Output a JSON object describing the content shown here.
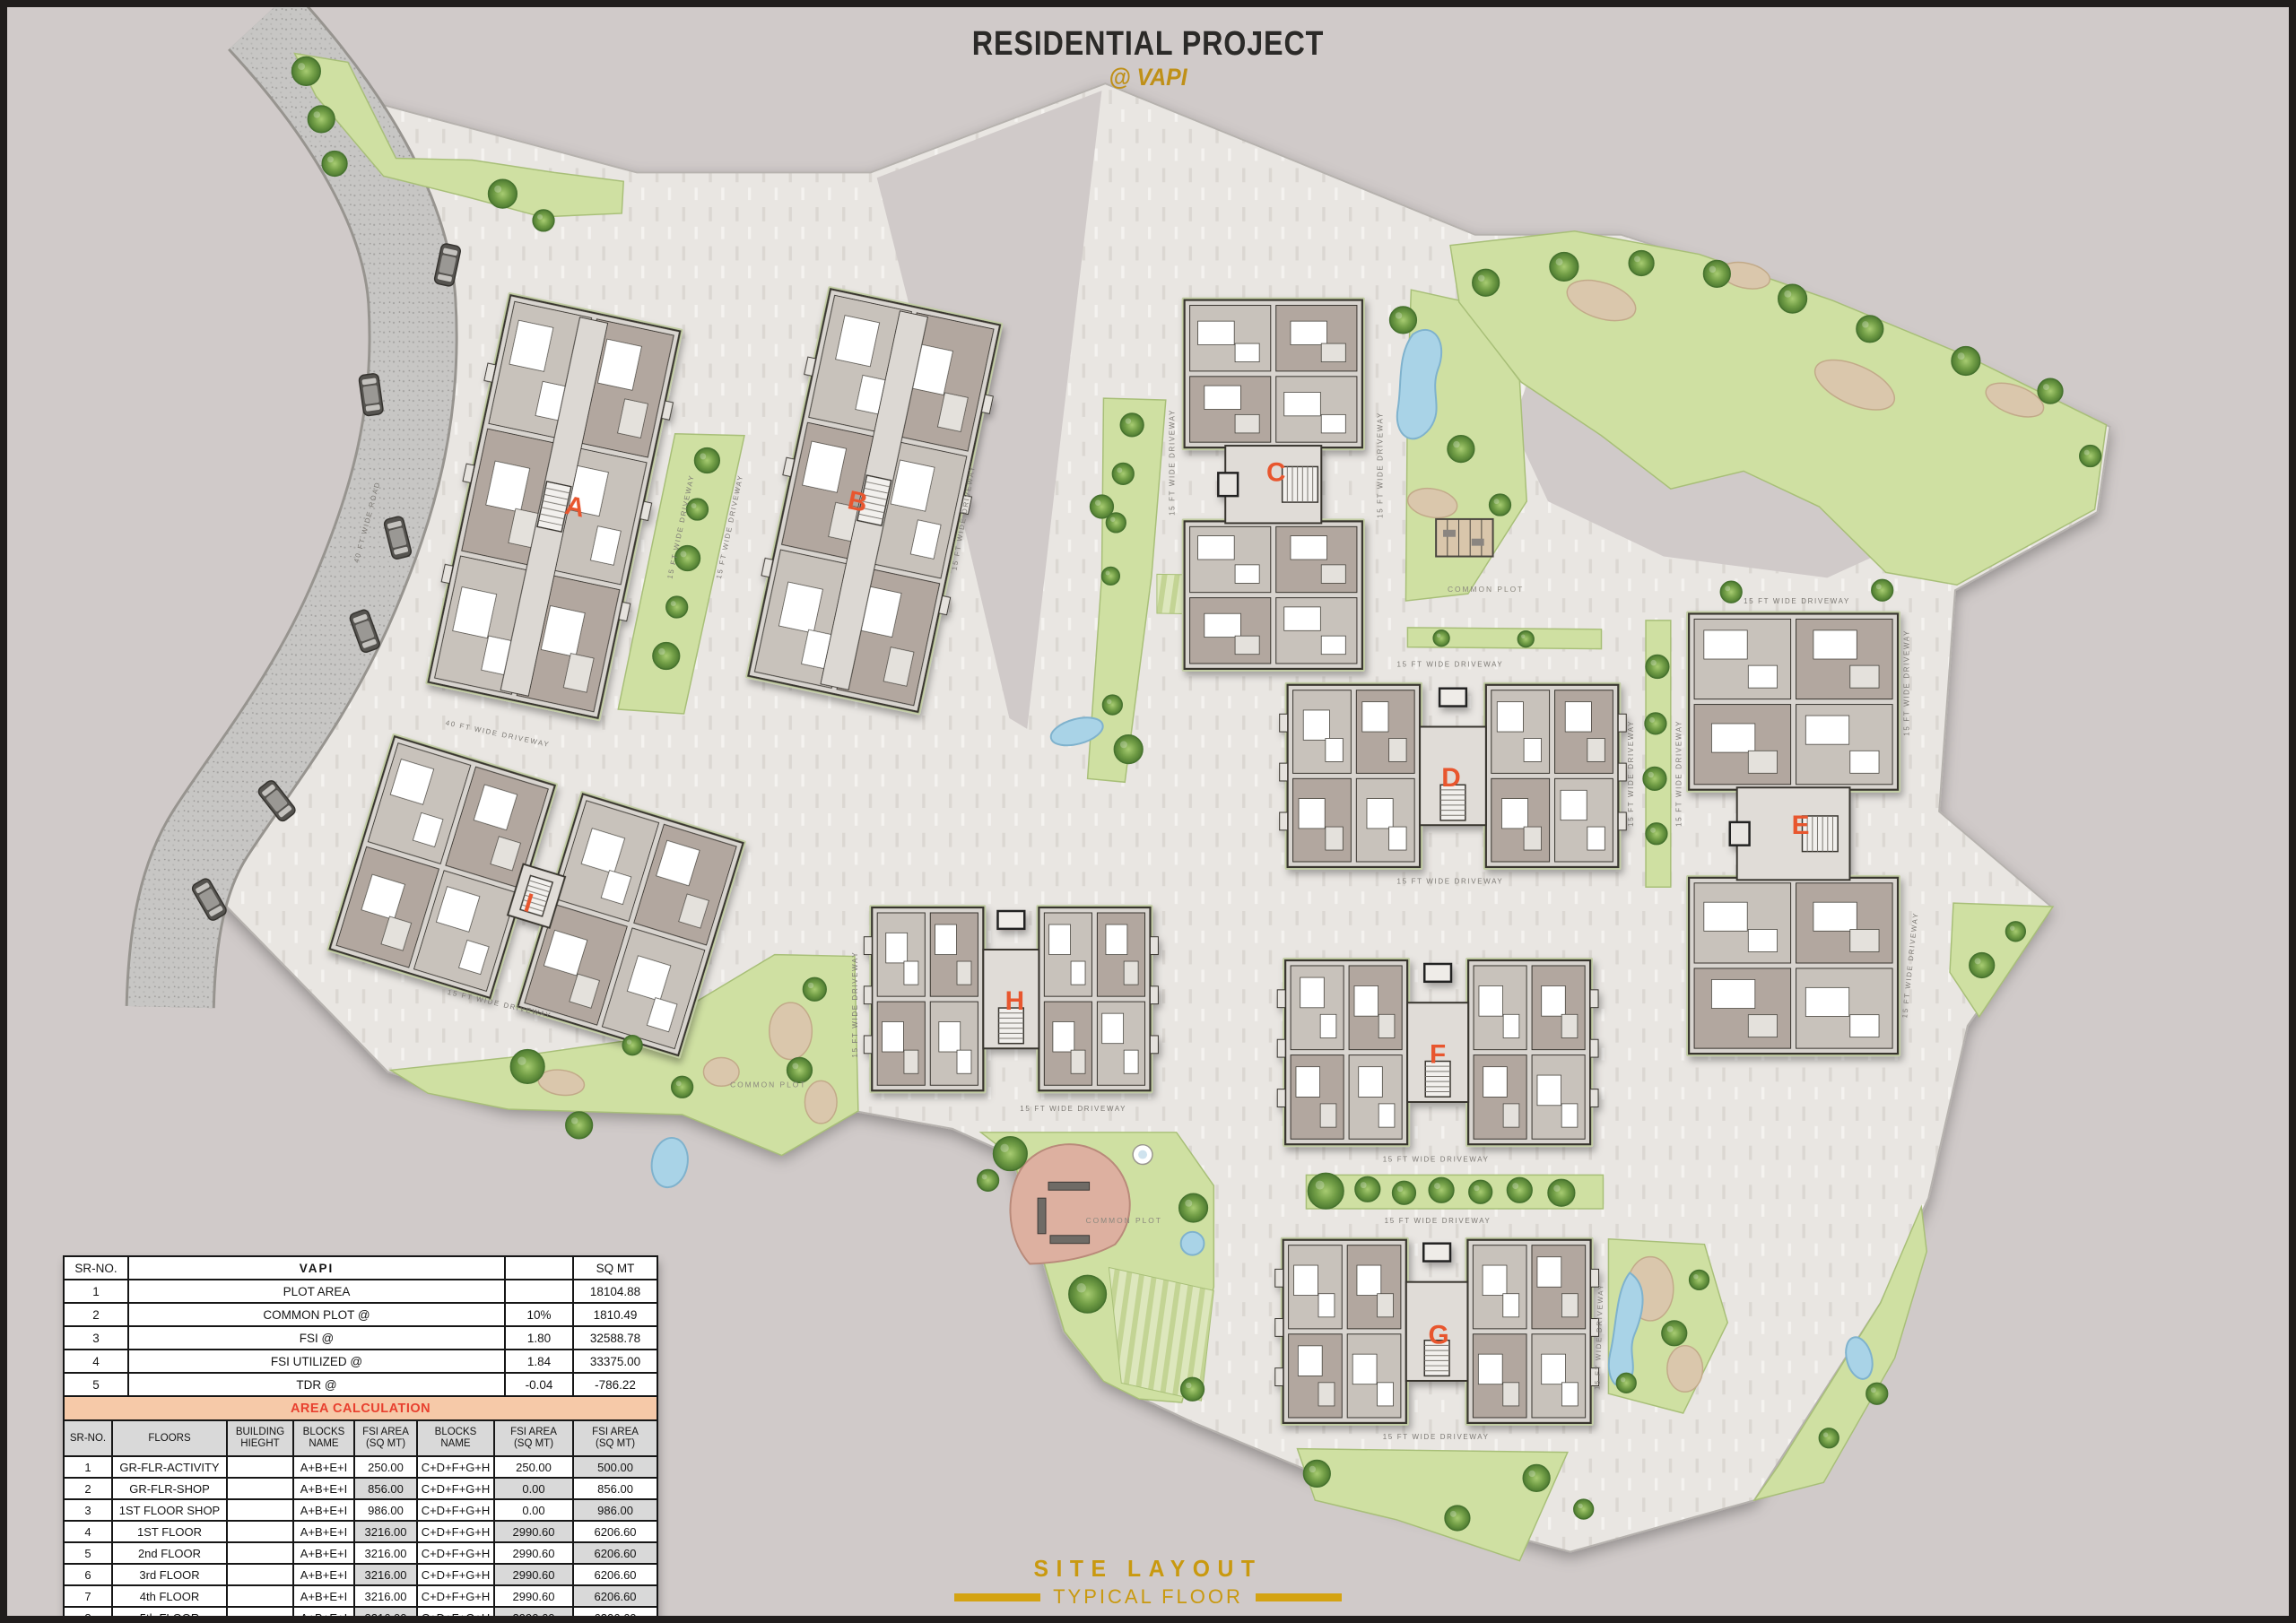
{
  "title": {
    "main": "RESIDENTIAL PROJECT",
    "sub": "@ VAPI"
  },
  "footer": {
    "line1": "SITE LAYOUT",
    "line2": "TYPICAL FLOOR"
  },
  "plan": {
    "road_label": "40 FT WIDE ROAD",
    "driveway40_label": "40 FT WIDE DRIVEWAY",
    "driveway15_label": "15 FT WIDE DRIVEWAY",
    "common_plot_label": "COMMON PLOT",
    "buildings": [
      {
        "letter": "A"
      },
      {
        "letter": "B"
      },
      {
        "letter": "C"
      },
      {
        "letter": "D"
      },
      {
        "letter": "E"
      },
      {
        "letter": "F"
      },
      {
        "letter": "G"
      },
      {
        "letter": "H"
      },
      {
        "letter": "I"
      }
    ]
  },
  "summary_table": {
    "header": {
      "sr": "SR-NO.",
      "city": "VAPI",
      "blank": "",
      "unit": "SQ MT"
    },
    "rows": [
      {
        "sr": "1",
        "label": "PLOT AREA",
        "ratio": "",
        "value": "18104.88",
        "ratio_class": "",
        "value_class": ""
      },
      {
        "sr": "2",
        "label": "COMMON PLOT @",
        "ratio": "10%",
        "value": "1810.49",
        "ratio_class": "red",
        "value_class": ""
      },
      {
        "sr": "3",
        "label": "FSI @",
        "ratio": "1.80",
        "value": "32588.78",
        "ratio_class": "red",
        "value_class": ""
      },
      {
        "sr": "4",
        "label": "FSI UTILIZED @",
        "ratio": "1.84",
        "value": "33375.00",
        "ratio_class": "red",
        "value_class": ""
      },
      {
        "sr": "5",
        "label": "TDR @",
        "ratio": "-0.04",
        "value": "-786.22",
        "ratio_class": "green",
        "value_class": "red"
      }
    ]
  },
  "area_table": {
    "section_title": "AREA CALCULATION",
    "columns": [
      {
        "l1": "SR-NO.",
        "l2": ""
      },
      {
        "l1": "FLOORS",
        "l2": ""
      },
      {
        "l1": "BUILDING",
        "l2": "HIEGHT"
      },
      {
        "l1": "BLOCKS",
        "l2": "NAME"
      },
      {
        "l1": "FSI AREA",
        "l2": "(SQ MT)"
      },
      {
        "l1": "BLOCKS",
        "l2": "NAME"
      },
      {
        "l1": "FSI AREA",
        "l2": "(SQ MT)"
      },
      {
        "l1": "FSI AREA",
        "l2": "(SQ MT)"
      }
    ],
    "rows": [
      {
        "sr": "1",
        "floor": "GR-FLR-ACTIVITY",
        "height": "",
        "b1": "A+B+E+I",
        "a1": "250.00",
        "b2": "C+D+F+G+H",
        "a2": "250.00",
        "total": "500.00",
        "hl": [
          "total"
        ]
      },
      {
        "sr": "2",
        "floor": "GR-FLR-SHOP",
        "height": "",
        "b1": "A+B+E+I",
        "a1": "856.00",
        "b2": "C+D+F+G+H",
        "a2": "0.00",
        "total": "856.00",
        "hl": [
          "a1",
          "a2"
        ]
      },
      {
        "sr": "3",
        "floor": "1ST FLOOR SHOP",
        "height": "",
        "b1": "A+B+E+I",
        "a1": "986.00",
        "b2": "C+D+F+G+H",
        "a2": "0.00",
        "total": "986.00",
        "hl": [
          "total"
        ]
      },
      {
        "sr": "4",
        "floor": "1ST FLOOR",
        "height": "",
        "b1": "A+B+E+I",
        "a1": "3216.00",
        "b2": "C+D+F+G+H",
        "a2": "2990.60",
        "total": "6206.60",
        "hl": [
          "a1",
          "a2"
        ]
      },
      {
        "sr": "5",
        "floor": "2nd FLOOR",
        "height": "",
        "b1": "A+B+E+I",
        "a1": "3216.00",
        "b2": "C+D+F+G+H",
        "a2": "2990.60",
        "total": "6206.60",
        "hl": [
          "total"
        ]
      },
      {
        "sr": "6",
        "floor": "3rd FLOOR",
        "height": "",
        "b1": "A+B+E+I",
        "a1": "3216.00",
        "b2": "C+D+F+G+H",
        "a2": "2990.60",
        "total": "6206.60",
        "hl": [
          "a1",
          "a2"
        ]
      },
      {
        "sr": "7",
        "floor": "4th FLOOR",
        "height": "",
        "b1": "A+B+E+I",
        "a1": "3216.00",
        "b2": "C+D+F+G+H",
        "a2": "2990.60",
        "total": "6206.60",
        "hl": [
          "total"
        ]
      },
      {
        "sr": "8",
        "floor": "5th FLOOR",
        "height": "",
        "b1": "A+B+E+I",
        "a1": "3216.00",
        "b2": "C+D+F+G+H",
        "a2": "2990.60",
        "total": "6206.60",
        "hl": [
          "a1",
          "a2"
        ]
      }
    ],
    "total_row": {
      "label": "TOTAL",
      "a1": "18172.00",
      "a2": "15203.00",
      "total": "33375.00"
    }
  },
  "colors": {
    "background": "#d0cac9",
    "paving": "#e9e6e2",
    "green": "#cfe0a2",
    "water": "#a9d3e7",
    "accent_orange": "#e8562e",
    "gold": "#c9990f",
    "table_red": "#e8402f",
    "table_green": "#17984d",
    "band_bg": "#f6c9a8",
    "cell_gray": "#d9d9d9"
  }
}
